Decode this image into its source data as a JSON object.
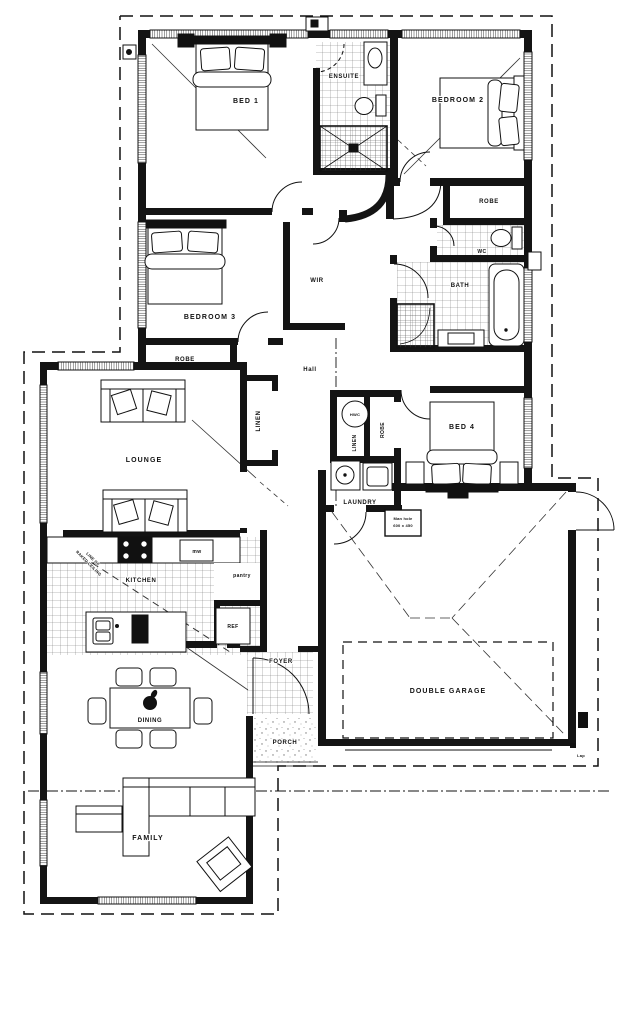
{
  "colors": {
    "ink": "#111111",
    "paper": "#ffffff",
    "tile_line": "#666666"
  },
  "labels": {
    "bed1": "BED 1",
    "ensuite": "ENSUITE",
    "bedroom2": "BEDROOM 2",
    "robe2": "ROBE",
    "wc": "WC",
    "bath": "BATH",
    "bedroom3": "BEDROOM 3",
    "robe3": "ROBE",
    "wir": "WIR",
    "hall": "Hall",
    "linen_left": "LINEN",
    "linen_right": "LINEN",
    "hwc": "HWC",
    "robe4": "ROBE",
    "bed4": "BED 4",
    "laundry": "LAUNDRY",
    "lounge": "LOUNGE",
    "kitchen": "KITCHEN",
    "microwave": "mw",
    "pantry": "pantry",
    "fridge": "REF",
    "dining": "DINING",
    "foyer": "FOYER",
    "porch": "PORCH",
    "family": "FAMILY",
    "garage": "DOUBLE GARAGE"
  },
  "annotations": {
    "raked_line1": "LINE OF",
    "raked_line2": "RAKED CEILING",
    "manhole_line1": "Man hole",
    "manhole_line2": "600 x 450",
    "lap": "Lap"
  }
}
